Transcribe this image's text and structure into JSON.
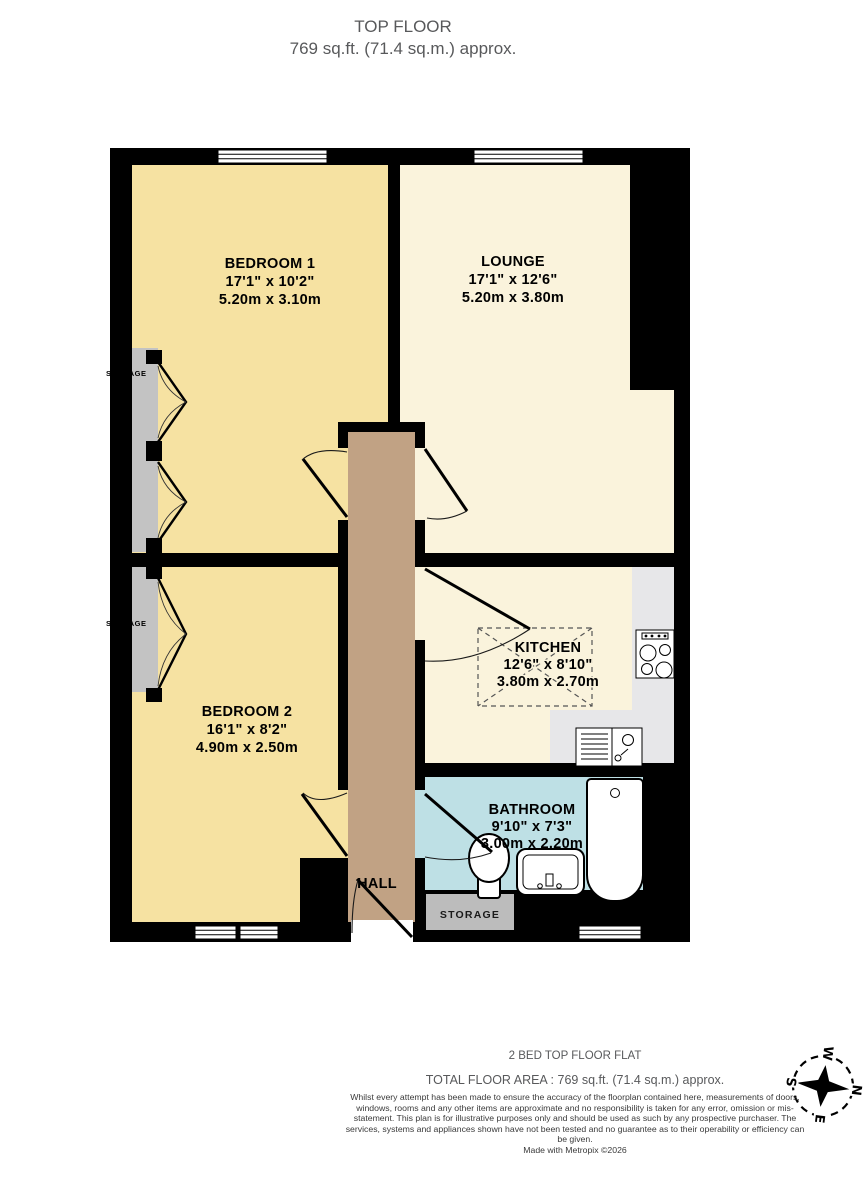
{
  "title": {
    "floor": "TOP FLOOR",
    "area": "769 sq.ft. (71.4 sq.m.) approx."
  },
  "rooms": {
    "bedroom1": {
      "name": "BEDROOM 1",
      "imperial": "17'1\" x 10'2\"",
      "metric": "5.20m x 3.10m"
    },
    "lounge": {
      "name": "LOUNGE",
      "imperial": "17'1\" x 12'6\"",
      "metric": "5.20m x 3.80m"
    },
    "bedroom2": {
      "name": "BEDROOM 2",
      "imperial": "16'1\" x 8'2\"",
      "metric": "4.90m x 2.50m"
    },
    "kitchen": {
      "name": "KITCHEN",
      "imperial": "12'6\" x 8'10\"",
      "metric": "3.80m x 2.70m"
    },
    "bathroom": {
      "name": "BATHROOM",
      "imperial": "9'10\" x 7'3\"",
      "metric": "3.00m x 2.20m"
    },
    "hall": {
      "name": "HALL"
    },
    "storage_hall": {
      "name": "STORAGE"
    },
    "storage_bedroom1": {
      "name": "STORAGE"
    },
    "storage_bedroom2": {
      "name": "STORAGE"
    }
  },
  "compass": {
    "north": "N",
    "east": "E",
    "south": "S",
    "west": "W"
  },
  "footer": {
    "property_type": "2 BED TOP FLOOR FLAT",
    "total_area": "TOTAL FLOOR AREA : 769 sq.ft. (71.4 sq.m.) approx.",
    "disclaimer": "Whilst every attempt has been made to ensure the accuracy of the floorplan contained here, measurements of doors, windows, rooms and any other items are approximate and no responsibility is taken for any error, omission or mis-statement. This plan is for illustrative purposes only and should be used as such by any prospective purchaser. The services, systems and appliances shown have not been tested and no guarantee as to their operability or efficiency can be given.",
    "credit": "Made with Metropix ©2026"
  },
  "colors": {
    "bedroom": "#F6E2A2",
    "living": "#FAF3DC",
    "hall": "#C1A284",
    "bathroom": "#BEE0E5",
    "counter": "#E7E7E9",
    "storage": "#C3C3C3",
    "storage_box": "#BCBCBC",
    "wall": "#000000",
    "muted_text": "#58595B",
    "disclaimer_text": "#3A3A3A"
  }
}
